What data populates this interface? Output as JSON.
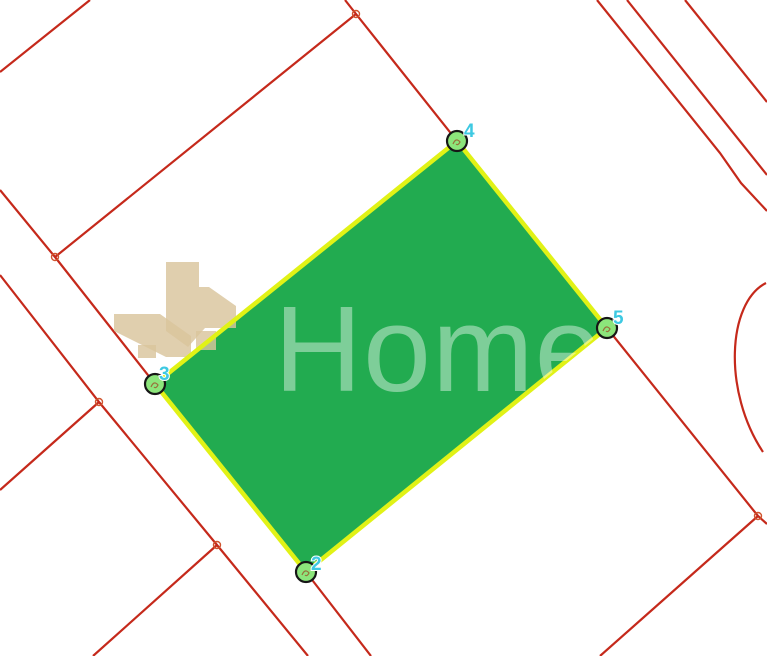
{
  "map": {
    "background_color": "#ffffff",
    "watermark": {
      "text": "Home",
      "text_color": "rgba(255,255,255,0.42)",
      "text_x": 274,
      "text_y": 391,
      "logo_color": "#d9c49c",
      "logo_opacity": 0.82,
      "logo_paths": [
        "M166,262 L199,262 L199,287 L209,287 L236,306 L236,328 L205,328 L188,347 L166,331 Z",
        "M196,331 h20 v19 h-20 Z",
        "M114,314 L160,314 L191,336 L191,357 L166,357 L114,331 Z",
        "M138,345 h18 v13 h-18 Z"
      ]
    },
    "parcel": {
      "fill_color": "#22ab50",
      "border_color": "#e1f216",
      "border_width": 4.5,
      "vertices": [
        {
          "label": "2",
          "x": 306,
          "y": 572,
          "label_x": 311,
          "label_y": 570
        },
        {
          "label": "3",
          "x": 155,
          "y": 384,
          "label_x": 159,
          "label_y": 380
        },
        {
          "label": "4",
          "x": 457,
          "y": 141,
          "label_x": 464,
          "label_y": 137
        },
        {
          "label": "5",
          "x": 607,
          "y": 328,
          "label_x": 613,
          "label_y": 324
        }
      ],
      "vertex_marker": {
        "radius": 10,
        "fill": "#8ce57b",
        "stroke": "#161616",
        "stroke_width": 2.2,
        "inner_mark_color": "#9c4a26",
        "label_color": "#3ec9e2"
      }
    },
    "boundary_lines": {
      "color": "#c5291b",
      "width": 2.2,
      "segments": [
        {
          "name": "road-line-topleft",
          "points": [
            [
              90,
              0
            ],
            [
              0,
              72
            ]
          ]
        },
        {
          "name": "road-line-to-vertex4",
          "points": [
            [
              345,
              0
            ],
            [
              356,
              14
            ],
            [
              457,
              141
            ]
          ]
        },
        {
          "name": "road-line-j2-j1",
          "points": [
            [
              55,
              257
            ],
            [
              356,
              14
            ]
          ]
        },
        {
          "name": "road-line-to-vertex3",
          "points": [
            [
              0,
              190
            ],
            [
              55,
              257
            ],
            [
              155,
              384
            ]
          ]
        },
        {
          "name": "road-line-left-long",
          "points": [
            [
              0,
              275
            ],
            [
              99,
              402
            ],
            [
              217,
              545
            ],
            [
              308,
              656
            ]
          ]
        },
        {
          "name": "road-line-j3-branch",
          "points": [
            [
              99,
              402
            ],
            [
              0,
              490
            ]
          ]
        },
        {
          "name": "road-line-j4-branch",
          "points": [
            [
              217,
              545
            ],
            [
              93,
              656
            ]
          ]
        },
        {
          "name": "road-line-from-vertex2",
          "points": [
            [
              306,
              572
            ],
            [
              371,
              656
            ]
          ]
        },
        {
          "name": "road-line-from-vertex5",
          "points": [
            [
              607,
              328
            ],
            [
              758,
              516
            ],
            [
              767,
              524
            ]
          ]
        },
        {
          "name": "road-line-j5-branch",
          "points": [
            [
              758,
              516
            ],
            [
              600,
              656
            ]
          ]
        },
        {
          "name": "road-line-topright-1",
          "points": [
            [
              597,
              0
            ],
            [
              720,
              153
            ],
            [
              741,
              183
            ],
            [
              767,
              211
            ]
          ]
        },
        {
          "name": "road-line-topright-2",
          "points": [
            [
              627,
              0
            ],
            [
              767,
              175
            ]
          ]
        },
        {
          "name": "road-line-topright-3",
          "points": [
            [
              685,
              0
            ],
            [
              767,
              102
            ]
          ]
        }
      ],
      "arc_path": "M766,283 C727,303 723,392 763,452",
      "junctions": [
        {
          "x": 356,
          "y": 14
        },
        {
          "x": 55,
          "y": 257
        },
        {
          "x": 99,
          "y": 402
        },
        {
          "x": 217,
          "y": 545
        },
        {
          "x": 758,
          "y": 516
        }
      ],
      "junction_marker": {
        "radius": 3.5,
        "stroke": "#d0542e",
        "stroke_width": 1.4
      }
    }
  }
}
